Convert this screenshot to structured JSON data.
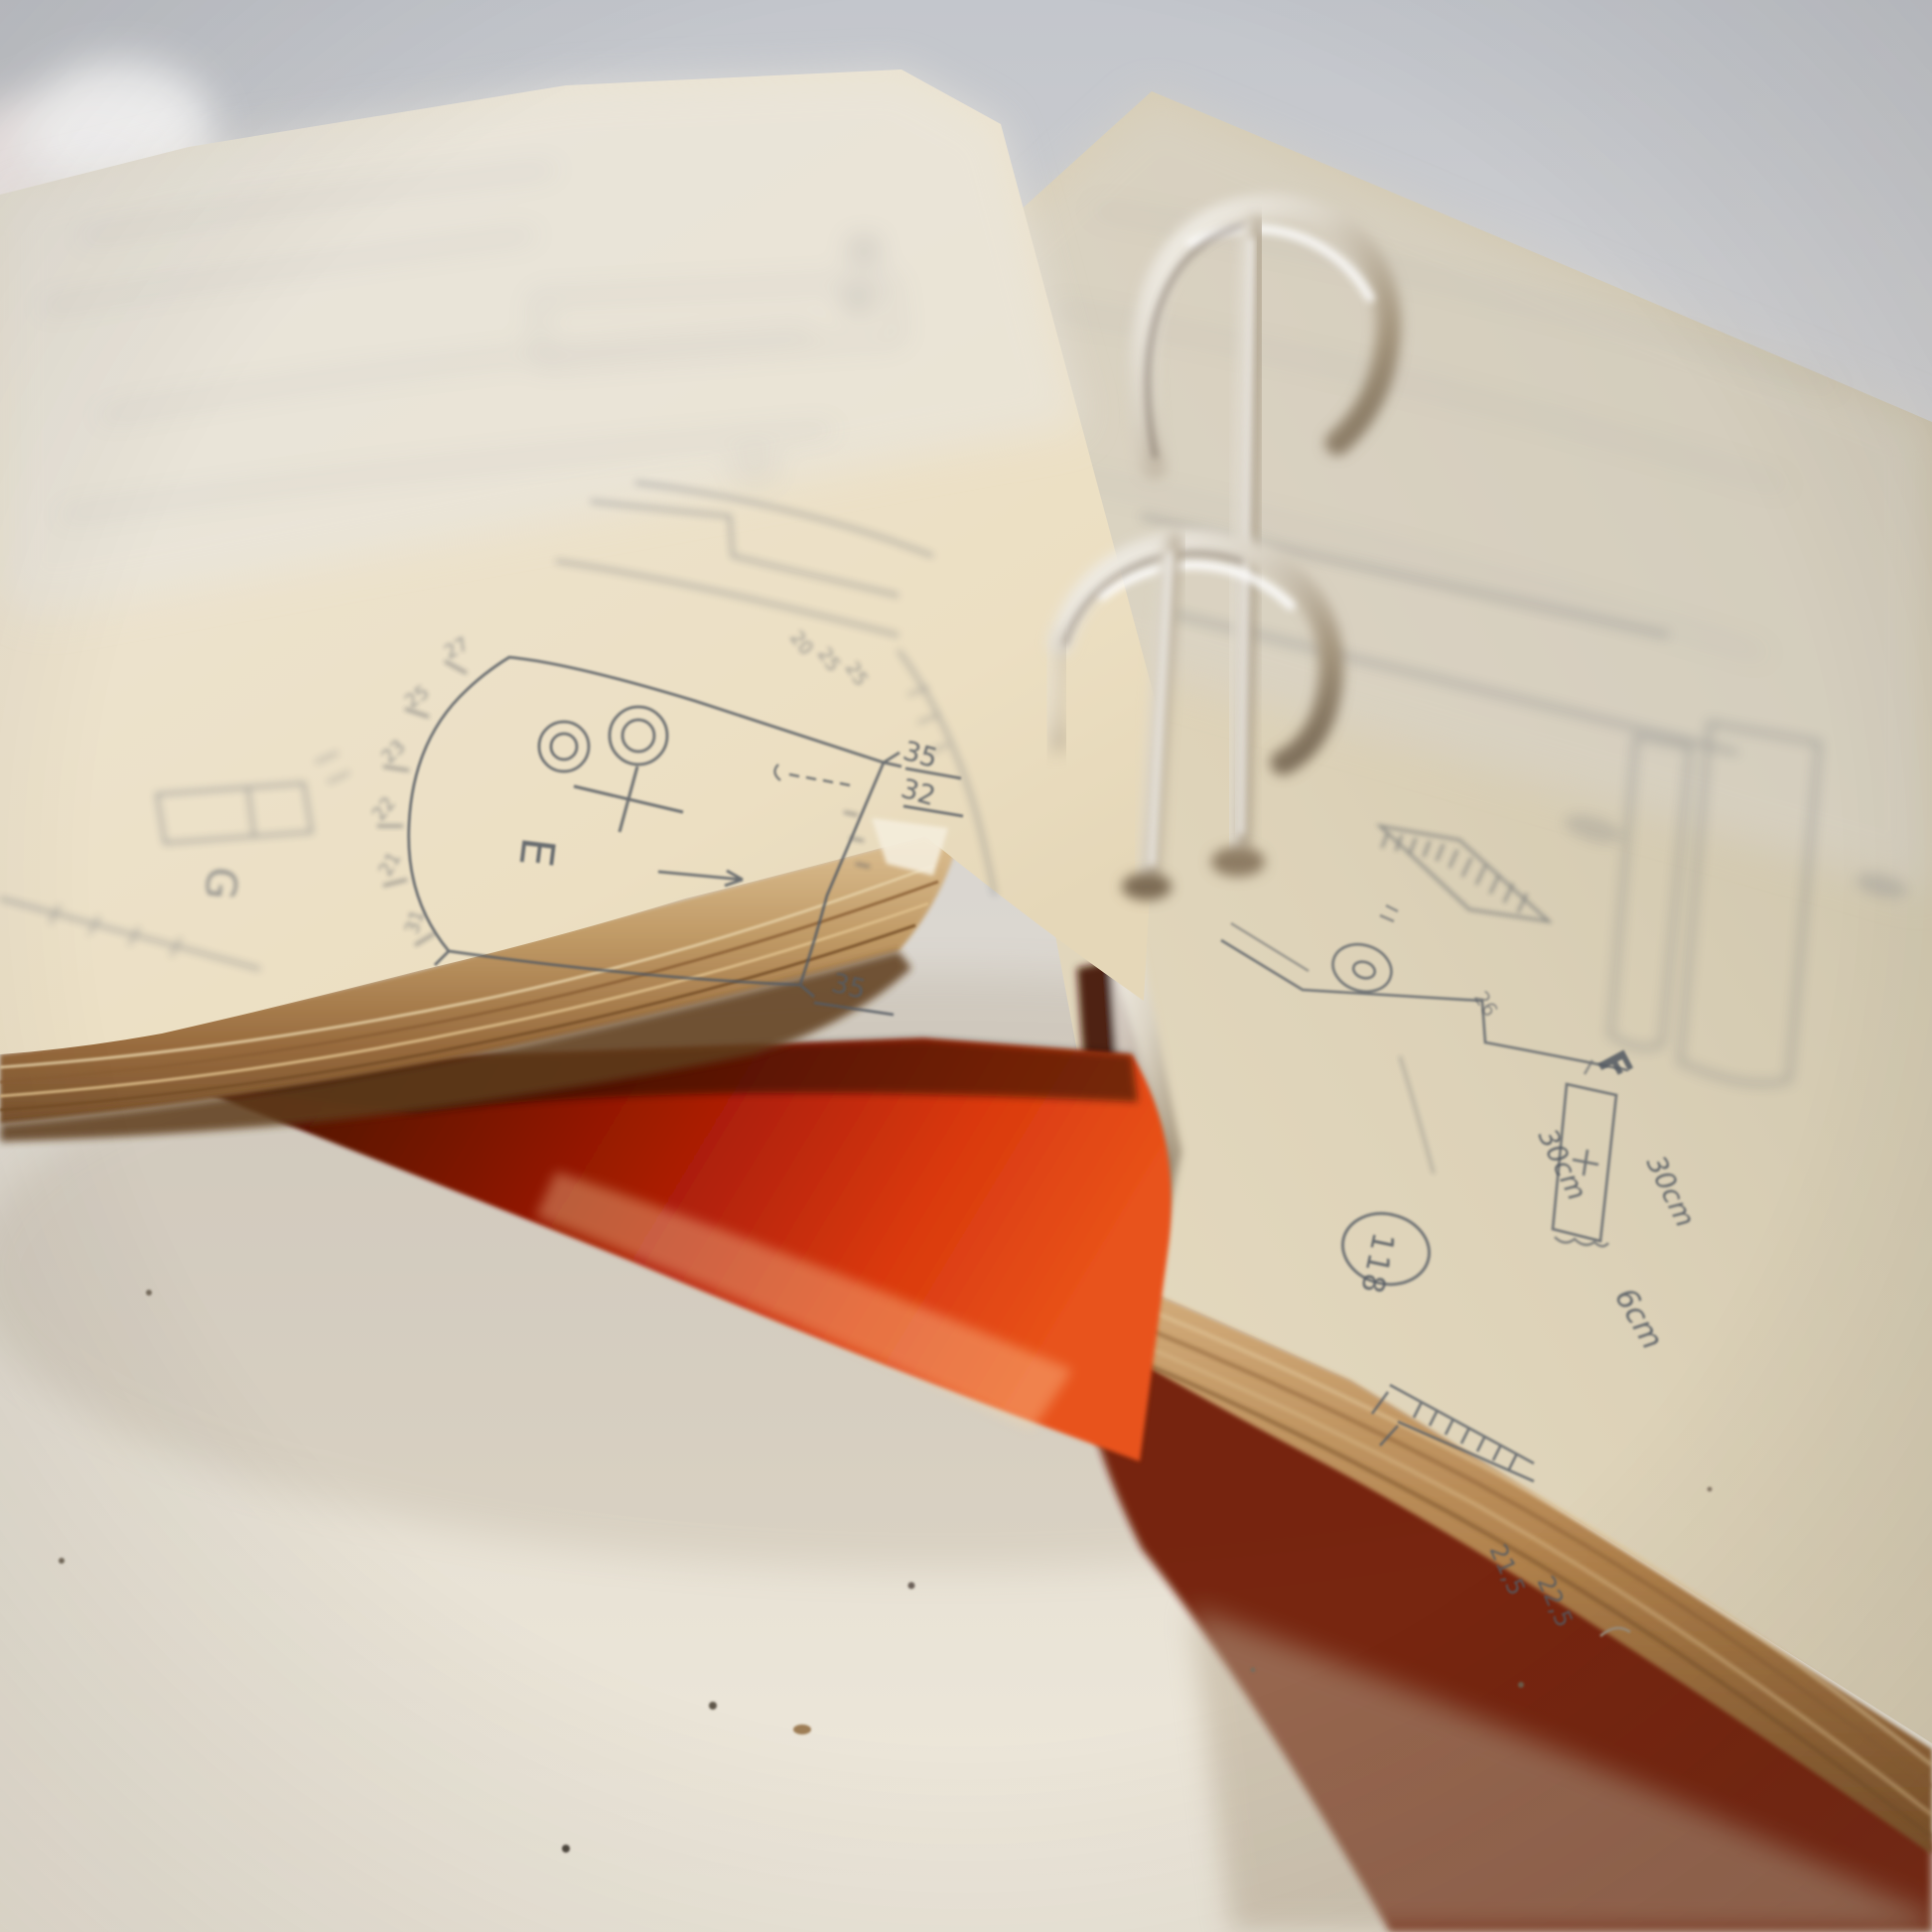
{
  "binder": {
    "cover_color": "#c22508",
    "ring_metal_color": "#d8cdbb",
    "paper_left_color": "#e9ddc5",
    "paper_right_color": "#dcd2bb",
    "pencil_color": "#5a6068"
  },
  "left_page": {
    "piece_e_label": "E",
    "piece_g_label": "G",
    "edge_dim_top": "35",
    "edge_dim_mid": "32",
    "corner_dim": "35",
    "edge_ticks": [
      "27",
      "25",
      "23",
      "22",
      "21",
      "31"
    ],
    "upper_ticks": [
      "20",
      "25",
      "25"
    ]
  },
  "right_page": {
    "page_number": "118",
    "piece_f_label": "F",
    "dim_left": "30cm",
    "dim_right": "30cm",
    "dim_bottom": "6cm",
    "dim_small": "26",
    "corner_dims": [
      "21,5",
      "22,5"
    ]
  }
}
